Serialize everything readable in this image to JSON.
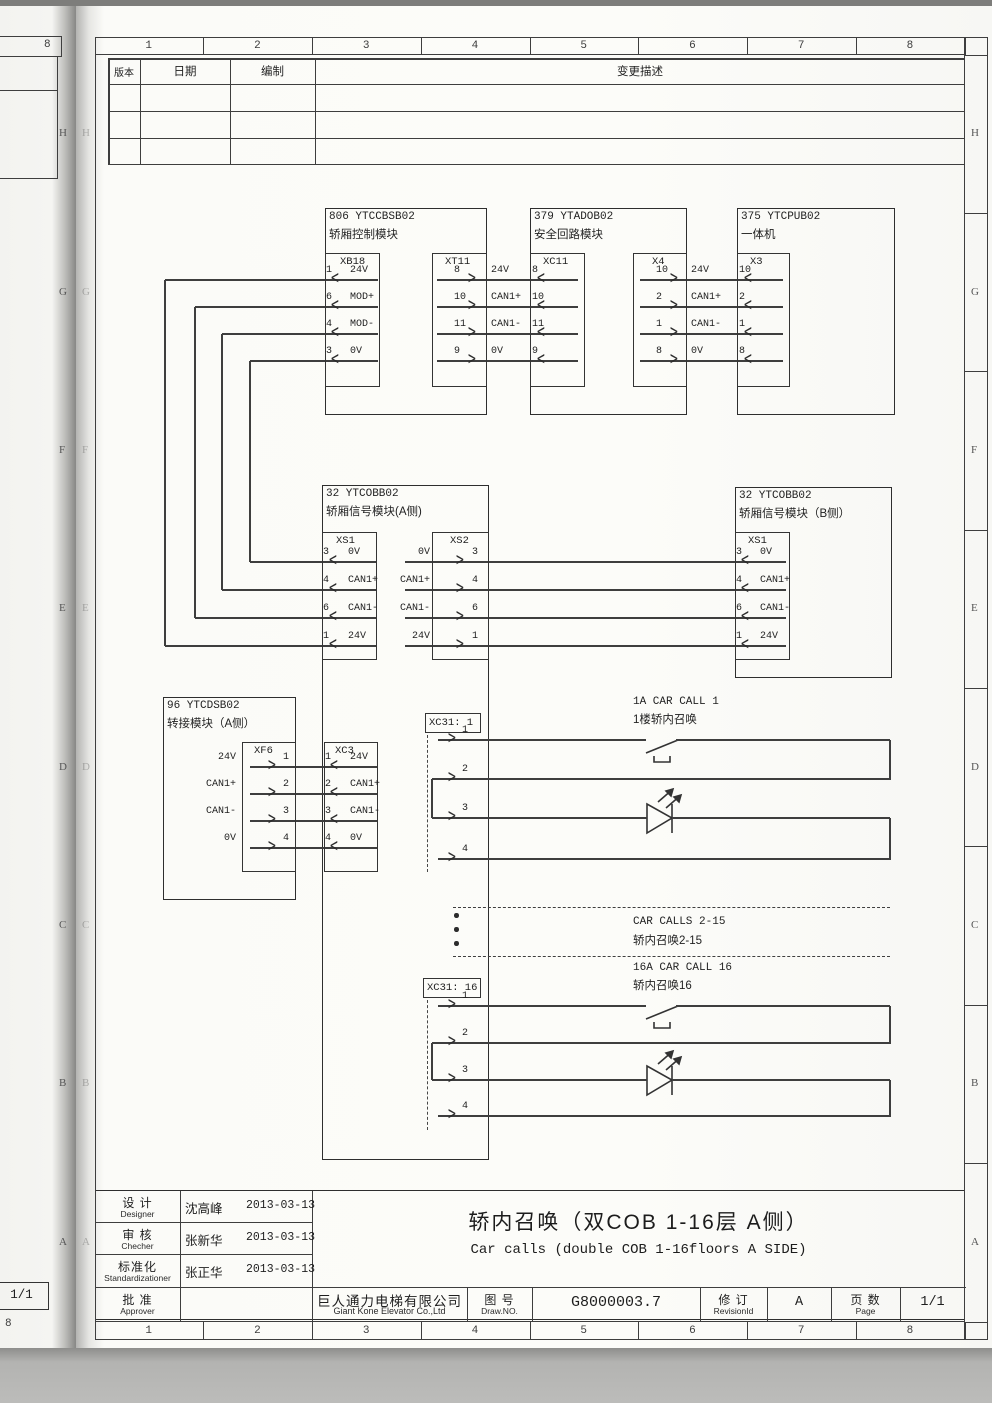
{
  "sheet": {
    "top_numbers": [
      "1",
      "2",
      "3",
      "4",
      "5",
      "6",
      "7",
      "8"
    ],
    "bottom_numbers": [
      "1",
      "2",
      "3",
      "4",
      "5",
      "6",
      "7",
      "8"
    ],
    "right_letters": [
      "H",
      "G",
      "F",
      "E",
      "D",
      "C",
      "B",
      "A"
    ],
    "left_letters": [
      "H",
      "G",
      "F",
      "E",
      "D",
      "C",
      "B",
      "A"
    ],
    "underlay": {
      "top_number": "8",
      "page_box": "1/1",
      "bottom_number": "8",
      "letters": [
        "H",
        "G",
        "F",
        "E",
        "D",
        "C",
        "B",
        "A"
      ]
    }
  },
  "revision_table": {
    "col_version": "版本",
    "col_date": "日期",
    "col_author": "编制",
    "col_desc": "变更描述"
  },
  "modules": {
    "m806": {
      "code": "806 YTCCBSB02",
      "name": "轿厢控制模块"
    },
    "m379": {
      "code": "379 YTADOB02",
      "name": "安全回路模块"
    },
    "m375": {
      "code": "375 YTCPUB02",
      "name": "一体机"
    },
    "mcobA": {
      "code": "32 YTCOBB02",
      "name": "轿厢信号模块(A侧)"
    },
    "mcobB": {
      "code": "32 YTCOBB02",
      "name": "轿厢信号模块（B侧）"
    },
    "m96": {
      "code": "96 YTCDSB02",
      "name": "转接模块（A侧）"
    }
  },
  "connectors": {
    "XB18": {
      "label": "XB18",
      "pins": [
        {
          "n": "1",
          "s": "24V"
        },
        {
          "n": "6",
          "s": "MOD+"
        },
        {
          "n": "4",
          "s": "MOD-"
        },
        {
          "n": "3",
          "s": "0V"
        }
      ]
    },
    "XT11": {
      "label": "XT11",
      "pins": [
        {
          "n": "8"
        },
        {
          "n": "10"
        },
        {
          "n": "11"
        },
        {
          "n": "9"
        }
      ]
    },
    "XC11": {
      "label": "XC11",
      "pins": [
        {
          "n": "8"
        },
        {
          "n": "10"
        },
        {
          "n": "11"
        },
        {
          "n": "9"
        }
      ]
    },
    "X4": {
      "label": "X4",
      "pins": [
        {
          "n": "10"
        },
        {
          "n": "2"
        },
        {
          "n": "1"
        },
        {
          "n": "8"
        }
      ]
    },
    "X3": {
      "label": "X3",
      "pins": [
        {
          "n": "10"
        },
        {
          "n": "2"
        },
        {
          "n": "1"
        },
        {
          "n": "8"
        }
      ]
    },
    "XS1A": {
      "label": "XS1",
      "pins": [
        {
          "n": "3",
          "s": "0V"
        },
        {
          "n": "4",
          "s": "CAN1+"
        },
        {
          "n": "6",
          "s": "CAN1-"
        },
        {
          "n": "1",
          "s": "24V"
        }
      ]
    },
    "XS2": {
      "label": "XS2",
      "pins": [
        {
          "n": "3",
          "s": "0V"
        },
        {
          "n": "4",
          "s": "CAN1+"
        },
        {
          "n": "6",
          "s": "CAN1-"
        },
        {
          "n": "1",
          "s": "24V"
        }
      ]
    },
    "XS1B": {
      "label": "XS1",
      "pins": [
        {
          "n": "3",
          "s": "0V"
        },
        {
          "n": "4",
          "s": "CAN1+"
        },
        {
          "n": "6",
          "s": "CAN1-"
        },
        {
          "n": "1",
          "s": "24V"
        }
      ]
    },
    "XF6": {
      "label": "XF6",
      "pins": [
        {
          "n": "1",
          "s": "24V"
        },
        {
          "n": "2",
          "s": "CAN1+"
        },
        {
          "n": "3",
          "s": "CAN1-"
        },
        {
          "n": "4",
          "s": "0V"
        }
      ]
    },
    "XC3": {
      "label": "XC3",
      "pins": [
        {
          "n": "1",
          "s": "24V"
        },
        {
          "n": "2",
          "s": "CAN1+"
        },
        {
          "n": "3",
          "s": "CAN1-"
        },
        {
          "n": "4",
          "s": "0V"
        }
      ]
    },
    "XC31_1": {
      "label": "XC31: 1",
      "pins": [
        {
          "n": "1"
        },
        {
          "n": "2"
        },
        {
          "n": "3"
        },
        {
          "n": "4"
        }
      ]
    },
    "XC31_16": {
      "label": "XC31: 16",
      "pins": [
        {
          "n": "1"
        },
        {
          "n": "2"
        },
        {
          "n": "3"
        },
        {
          "n": "4"
        }
      ]
    }
  },
  "net_labels": {
    "bus": [
      "24V",
      "CAN1+",
      "CAN1-",
      "0V"
    ]
  },
  "car_calls": {
    "call1": {
      "en": "1A CAR CALL 1",
      "zh": "1楼轿内召唤"
    },
    "calls2_15": {
      "en": "CAR CALLS 2-15",
      "zh": "轿内召唤2-15"
    },
    "call16": {
      "en": "16A CAR CALL 16",
      "zh": "轿内召唤16"
    }
  },
  "title_block": {
    "rows": [
      {
        "zh": "设 计",
        "en": "Designer",
        "name": "沈高峰",
        "date": "2013-03-13"
      },
      {
        "zh": "审 核",
        "en": "Checher",
        "name": "张新华",
        "date": "2013-03-13"
      },
      {
        "zh": "标准化",
        "en": "Standardizationer",
        "name": "张正华",
        "date": "2013-03-13"
      },
      {
        "zh": "批 准",
        "en": "Approver",
        "name": "",
        "date": ""
      }
    ],
    "company_zh": "巨人通力电梯有限公司",
    "company_en": "Giant Kone Elevator Co.,Ltd",
    "drawno_zh": "图 号",
    "drawno_en": "Draw.NO.",
    "draw_no": "G8000003.7",
    "rev_zh": "修 订",
    "rev_en": "RevisionId",
    "rev_val": "A",
    "page_zh": "页 数",
    "page_en": "Page",
    "page_val": "1/1",
    "title_zh": "轿内召唤（双COB 1-16层 A侧）",
    "title_en": "Car calls (double COB 1-16floors A SIDE)"
  }
}
